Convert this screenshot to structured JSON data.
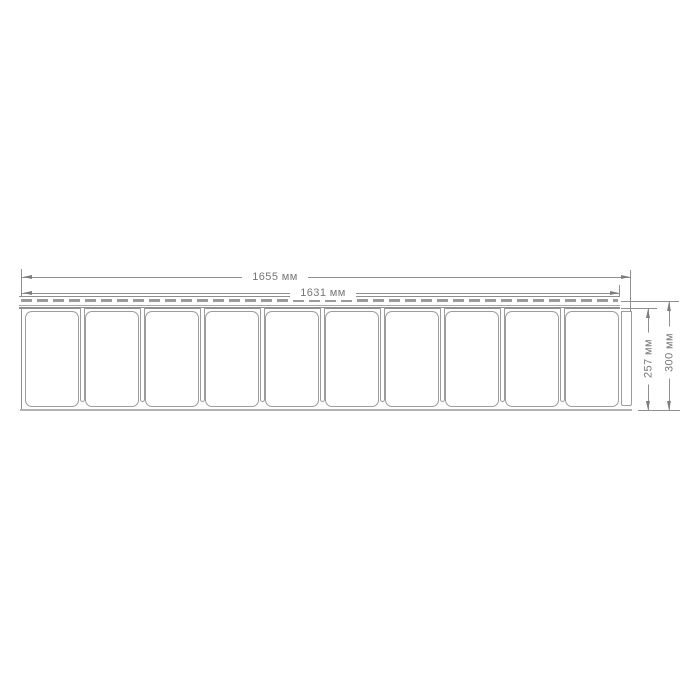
{
  "diagram": {
    "kind": "technical-dimension-drawing",
    "unit": "мм",
    "dimensions": {
      "overall_width": {
        "label": "1655 мм",
        "value_mm": 1655
      },
      "inner_width": {
        "label": "1631 мм",
        "value_mm": 1631
      },
      "inner_height": {
        "label": "257 мм",
        "value_mm": 257
      },
      "overall_height": {
        "label": "300 мм",
        "value_mm": 300
      }
    },
    "panel": {
      "plank_count": 10,
      "perforated_nail_strip": true
    },
    "colors": {
      "line": "#8f8f8f",
      "line_light": "#a8a8a8",
      "arrow": "#7d7d7d",
      "text": "#777777",
      "dash": "#9b9b9b",
      "base_line": "#b3b3b3",
      "fill": "#ffffff",
      "background": "#ffffff"
    }
  }
}
